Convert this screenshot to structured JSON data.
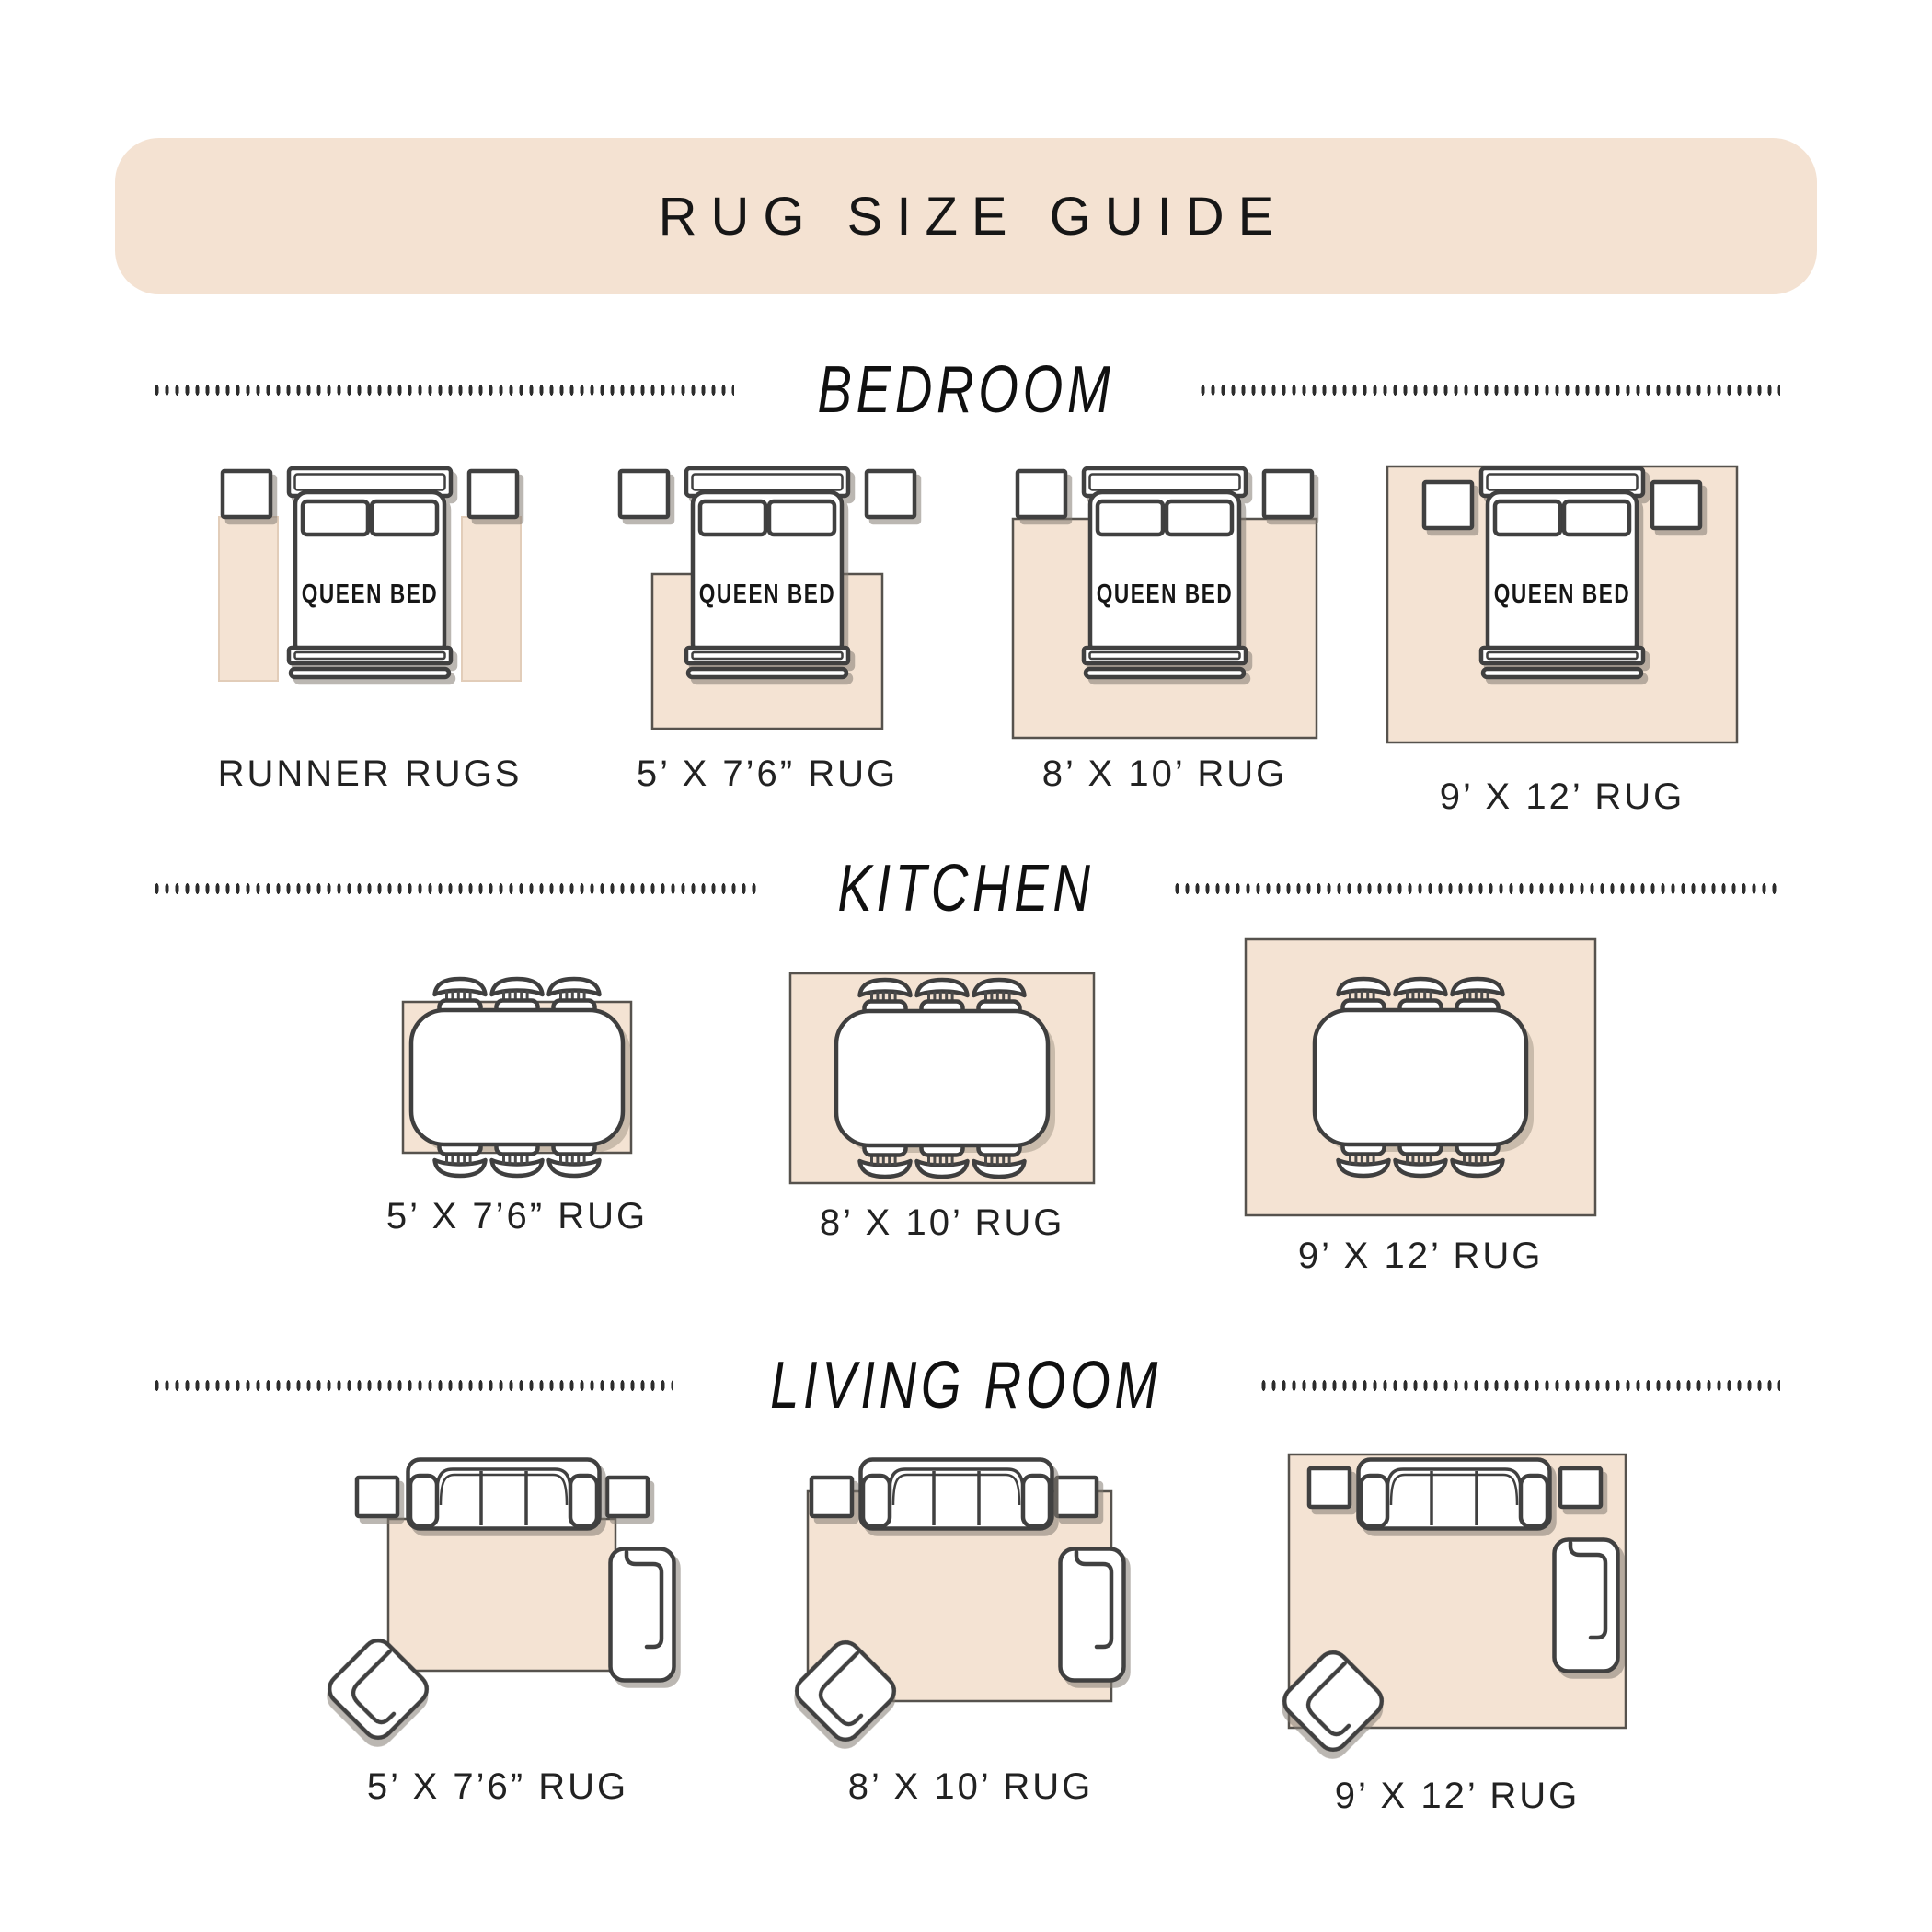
{
  "title": "RUG SIZE GUIDE",
  "bed_label": "QUEEN BED",
  "sections": {
    "bedroom": {
      "label": "BEDROOM",
      "items": [
        {
          "caption": "RUNNER RUGS"
        },
        {
          "caption": "5’ X 7’6” RUG"
        },
        {
          "caption": "8’ X 10’ RUG"
        },
        {
          "caption": "9’ X 12’ RUG"
        }
      ]
    },
    "kitchen": {
      "label": "KITCHEN",
      "items": [
        {
          "caption": "5’ X 7’6” RUG"
        },
        {
          "caption": "8’ X 10’ RUG"
        },
        {
          "caption": "9’ X 12’ RUG"
        }
      ]
    },
    "living": {
      "label": "LIVING ROOM",
      "items": [
        {
          "caption": "5’ X 7’6” RUG"
        },
        {
          "caption": "8’ X 10’ RUG"
        },
        {
          "caption": "9’ X 12’ RUG"
        }
      ]
    }
  },
  "colors": {
    "banner_background": "#f4e2d2",
    "rug_fill": "#f4e3d3",
    "furniture_outline": "#3f3f3f",
    "text": "#1a1a1a",
    "shadow": "#847b72"
  }
}
